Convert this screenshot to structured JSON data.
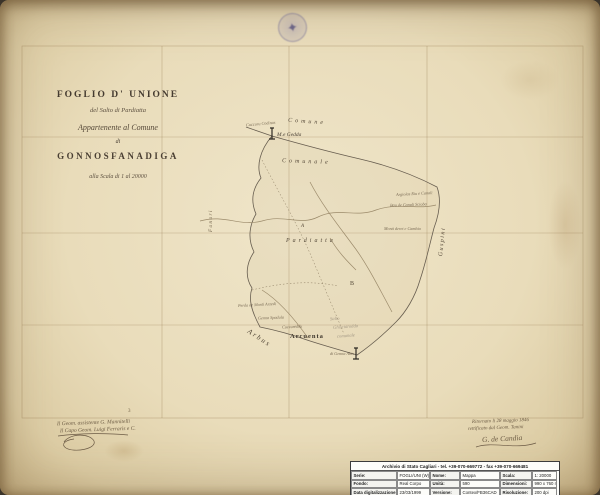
{
  "title_block": {
    "line1": "FOGLIO D' UNIONE",
    "line2": "del Salto di Pardiatta",
    "line3": "Appartenente al Comune",
    "line4": "di",
    "line5": "GONNOSFANADIGA",
    "line6": "alla Scala di 1 al 20000"
  },
  "stamp": {
    "glyph": "✦"
  },
  "grid": {
    "number_left": "3"
  },
  "map": {
    "region_top": "Comune",
    "peak": "M.e Gedda",
    "area_comunale": "Comunale",
    "area_salto": "Pardiatta",
    "marker_a": "A",
    "marker_b": "B",
    "village": "Arcuenta",
    "neighbor_sw": "Arbus",
    "neighbor_e": "Guspini",
    "neighbor_w": "Fanari",
    "boundary_notes": [
      "Cuccuru Codinas",
      "Argiolas Riu e Canali",
      "Bau de Canali Scioba",
      "Monti deret e Cambia",
      "Perda de Monti Arzedi",
      "Genna Spadula",
      "Cuccureddu",
      "di Genna Abis"
    ],
    "pencil_notes": [
      "Salto",
      "Ghisciarodda",
      "comunale"
    ]
  },
  "signatures": {
    "left": [
      "Il Geom. assistente G. Mannitelli",
      "Il Capo Geom. Luigi Ferraris e C."
    ],
    "right": [
      "Ritornato li 28 maggio 1846",
      "rettificato dal Geom. Tanini",
      "G. de Candia"
    ]
  },
  "footer": {
    "header": "Archivio di Stato Cagliari - tel. +39-070-669772 - fax +39-070-669481",
    "rows": [
      [
        {
          "label": "Serie:",
          "value": "FOGLI/UNI (W)"
        },
        {
          "label": "Nome:",
          "value": "Mappa"
        },
        {
          "label": "Scala:",
          "value": "1: 20000"
        }
      ],
      [
        {
          "label": "Fondo:",
          "value": "Real Corpo"
        },
        {
          "label": "Unità:",
          "value": "590"
        },
        {
          "label": "Dimensioni:",
          "value": "990 x 760 mm"
        }
      ],
      [
        {
          "label": "Data digitalizzazione:",
          "value": "23/03/1999"
        },
        {
          "label": "Versione:",
          "value": "Contex/FB36CAD"
        },
        {
          "label": "Risoluzione:",
          "value": "200 dpi"
        }
      ]
    ],
    "footer_line": "Società esecutrice: Techne spa - Cagliari"
  }
}
